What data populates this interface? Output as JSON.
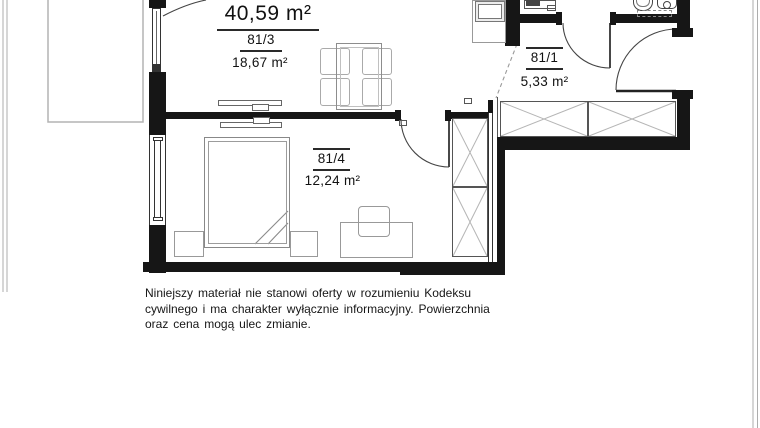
{
  "plan": {
    "title": "apartment-floor-plan",
    "total_area": "40,59 m²",
    "rooms": [
      {
        "number": "81/3",
        "area": "18,67 m²"
      },
      {
        "number": "81/1",
        "area": "5,33 m²"
      },
      {
        "number": "81/4",
        "area": "12,24 m²"
      }
    ],
    "colors": {
      "wall": "#161616",
      "furniture": "#999999",
      "balcony": "#b3b3b3",
      "text": "#111111",
      "background": "#ffffff"
    }
  },
  "disclaimer": {
    "line1": "Niniejszy materiał nie stanowi oferty w rozumieniu Kodeksu",
    "line2": "cywilnego i ma charakter wyłącznie informacyjny. Powierzchnia",
    "line3": "oraz cena mogą ulec zmianie."
  }
}
